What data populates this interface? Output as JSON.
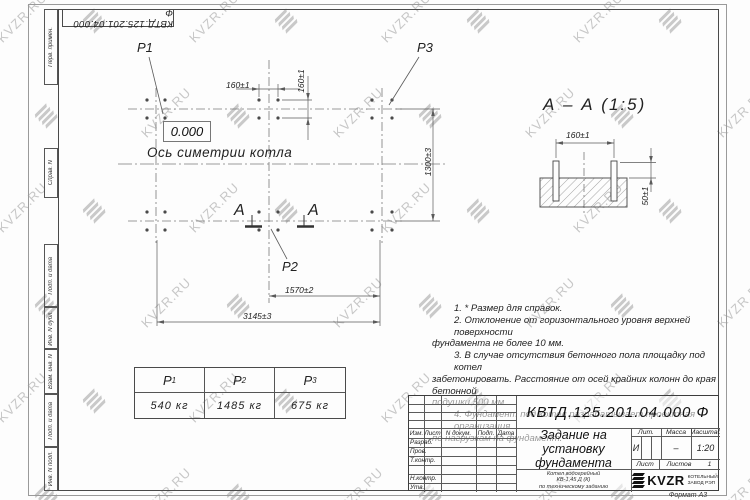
{
  "watermark": {
    "text": "KVZR.RU"
  },
  "corner_stamp": {
    "doc_number": "КВТД.125.201.04.000  Ф"
  },
  "margin": {
    "labels": [
      "Перв. примен.",
      "Справ. N",
      "Подп. и дата",
      "Инв. N дубл.",
      "Взам. инв. N",
      "Подп. и дата",
      "Инв. N подл."
    ]
  },
  "plan": {
    "level_mark": "0.000",
    "axis_label": "Ось симетрии котла",
    "load_labels": {
      "p1": "P1",
      "p2": "P2",
      "p3": "P3"
    },
    "section_letter_left": "А",
    "section_letter_right": "А",
    "dims": {
      "bolt_spacing_x": "160±1",
      "bolt_spacing_y": "160±1",
      "row_spacing": "1300±3",
      "mid_span": "1570±2",
      "total_span": "3145±3"
    }
  },
  "section_view": {
    "title": "А – А (1:5)",
    "dims": {
      "bolt_spacing": "160±1",
      "protrusion": "50±1"
    }
  },
  "notes": {
    "lines": [
      "1. * Размер для справок.",
      "2. Отклонение от горизонтального уровня верхней поверхности",
      "фундамента не более 10 мм.",
      "3. В случае отсутствия бетонного пола площадку под котел",
      "забетонировать. Расстояние от осей крайних колонн до края бетонной",
      "подушки 500 мм.",
      "4. Фундамент под котел разрабатывает проектная организация",
      "по нагрузкам на фундамент."
    ]
  },
  "load_table": {
    "headers": [
      {
        "base": "P",
        "sub": "1"
      },
      {
        "base": "P",
        "sub": "2"
      },
      {
        "base": "P",
        "sub": "3"
      }
    ],
    "values": [
      "540 кг",
      "1485 кг",
      "675 кг"
    ]
  },
  "title_block": {
    "doc_number": "КВТД.125.201.04.000  Ф",
    "title_lines": [
      "Задание на",
      "установку",
      "фундамента"
    ],
    "subtitle_lines": [
      "Котел водогрейный",
      "КВ-1,45 Д (К)",
      "по техническому заданию"
    ],
    "columns": [
      "Изм.",
      "Лист",
      "N докум.",
      "Подп.",
      "Дата"
    ],
    "sig_rows": [
      "Разраб.",
      "Пров.",
      "Т.контр.",
      "",
      "Н.контр.",
      "Утв."
    ],
    "lit_label": "Лит.",
    "mass_label": "Масса",
    "scale_label": "Масштаб",
    "lit_value": "И",
    "mass_value": "–",
    "scale_value": "1:20",
    "sheet_label": "Лист",
    "sheets_label": "Листов",
    "sheets_value": "1",
    "logo_text": "KVZR",
    "company_lines": [
      "КОТЕЛЬНЫЙ",
      "ЗАВОД РЭП"
    ],
    "format": "Формат А3"
  }
}
